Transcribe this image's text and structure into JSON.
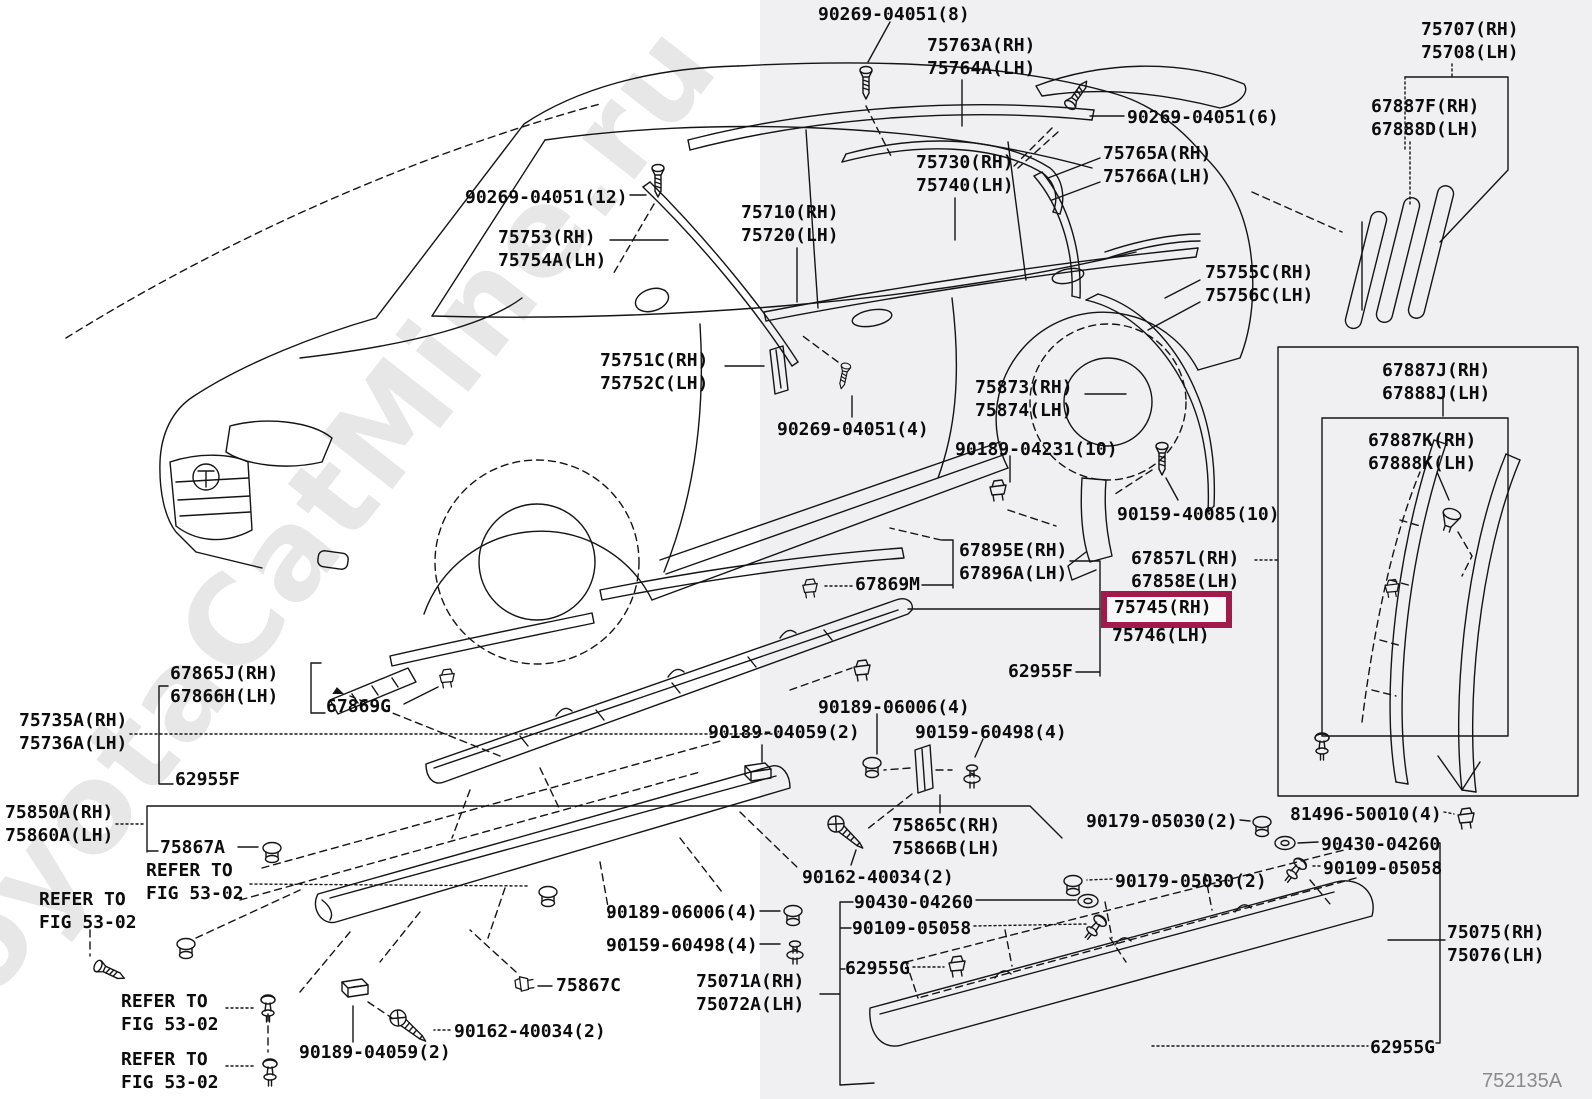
{
  "meta": {
    "figure_code": "752135A",
    "watermark": "ToyotaCatMine.ru"
  },
  "colors": {
    "highlight_box": "#a2194b",
    "right_panel_bg": "#f0f0f2",
    "line_color": "#141414"
  },
  "highlight": {
    "selected_part": "75745(RH)"
  },
  "labels": [
    {
      "id": "90269-04051-8",
      "text": "90269-04051(8)"
    },
    {
      "id": "75763A",
      "text": "75763A(RH)\n75764A(LH)"
    },
    {
      "id": "90269-04051-6",
      "text": "90269-04051(6)"
    },
    {
      "id": "75707",
      "text": "75707(RH)\n75708(LH)"
    },
    {
      "id": "67887F",
      "text": "67887F(RH)\n67888D(LH)"
    },
    {
      "id": "75730",
      "text": "75730(RH)\n75740(LH)"
    },
    {
      "id": "75765A",
      "text": "75765A(RH)\n75766A(LH)"
    },
    {
      "id": "90269-04051-12",
      "text": "90269-04051(12)"
    },
    {
      "id": "75753",
      "text": "75753(RH)\n75754A(LH)"
    },
    {
      "id": "75710",
      "text": "75710(RH)\n75720(LH)"
    },
    {
      "id": "75755C",
      "text": "75755C(RH)\n75756C(LH)"
    },
    {
      "id": "75751C",
      "text": "75751C(RH)\n75752C(LH)"
    },
    {
      "id": "75873",
      "text": "75873(RH)\n75874(LH)"
    },
    {
      "id": "90269-04051-4",
      "text": "90269-04051(4)"
    },
    {
      "id": "90189-04231-10",
      "text": "90189-04231(10)"
    },
    {
      "id": "90159-40085-10",
      "text": "90159-40085(10)"
    },
    {
      "id": "67887J",
      "text": "67887J(RH)\n67888J(LH)"
    },
    {
      "id": "67887K",
      "text": "67887K(RH)\n67888K(LH)"
    },
    {
      "id": "67895E",
      "text": "67895E(RH)\n67896A(LH)"
    },
    {
      "id": "67869M",
      "text": "67869M"
    },
    {
      "id": "67857L",
      "text": "67857L(RH)\n67858E(LH)"
    },
    {
      "id": "75745",
      "text": "75745(RH)"
    },
    {
      "id": "75746",
      "text": "75746(LH)"
    },
    {
      "id": "62955F-right",
      "text": "62955F"
    },
    {
      "id": "67865J",
      "text": "67865J(RH)\n67866H(LH)"
    },
    {
      "id": "67869G",
      "text": "67869G"
    },
    {
      "id": "75735A",
      "text": "75735A(RH)\n75736A(LH)"
    },
    {
      "id": "62955F-left",
      "text": "62955F"
    },
    {
      "id": "90189-06006-4t",
      "text": "90189-06006(4)"
    },
    {
      "id": "90189-04059-2t",
      "text": "90189-04059(2)"
    },
    {
      "id": "90159-60498-4t",
      "text": "90159-60498(4)"
    },
    {
      "id": "75850A",
      "text": "75850A(RH)\n75860A(LH)"
    },
    {
      "id": "75867A",
      "text": "75867A"
    },
    {
      "id": "refer-1",
      "text": "REFER TO\nFIG 53-02"
    },
    {
      "id": "refer-2",
      "text": "REFER TO\nFIG 53-02"
    },
    {
      "id": "75865C",
      "text": "75865C(RH)\n75866B(LH)"
    },
    {
      "id": "90162-40034-2t",
      "text": "90162-40034(2)"
    },
    {
      "id": "90189-06006-4b",
      "text": "90189-06006(4)"
    },
    {
      "id": "90159-60498-4b",
      "text": "90159-60498(4)"
    },
    {
      "id": "75867C",
      "text": "75867C"
    },
    {
      "id": "75071A",
      "text": "75071A(RH)\n75072A(LH)"
    },
    {
      "id": "90430-04260-l",
      "text": "90430-04260"
    },
    {
      "id": "90109-05058-l",
      "text": "90109-05058"
    },
    {
      "id": "62955G-left",
      "text": "62955G"
    },
    {
      "id": "90179-05030-2t",
      "text": "90179-05030(2)"
    },
    {
      "id": "81496-50010-4",
      "text": "81496-50010(4)"
    },
    {
      "id": "90430-04260-r",
      "text": "90430-04260"
    },
    {
      "id": "90109-05058-r",
      "text": "90109-05058"
    },
    {
      "id": "90179-05030-2b",
      "text": "90179-05030(2)"
    },
    {
      "id": "refer-3",
      "text": "REFER TO\nFIG 53-02"
    },
    {
      "id": "90189-04059-2b",
      "text": "90189-04059(2)"
    },
    {
      "id": "refer-4",
      "text": "REFER TO\nFIG 53-02"
    },
    {
      "id": "90162-40034-2b",
      "text": "90162-40034(2)"
    },
    {
      "id": "75075",
      "text": "75075(RH)\n75076(LH)"
    },
    {
      "id": "62955G-bottom",
      "text": "62955G"
    }
  ]
}
